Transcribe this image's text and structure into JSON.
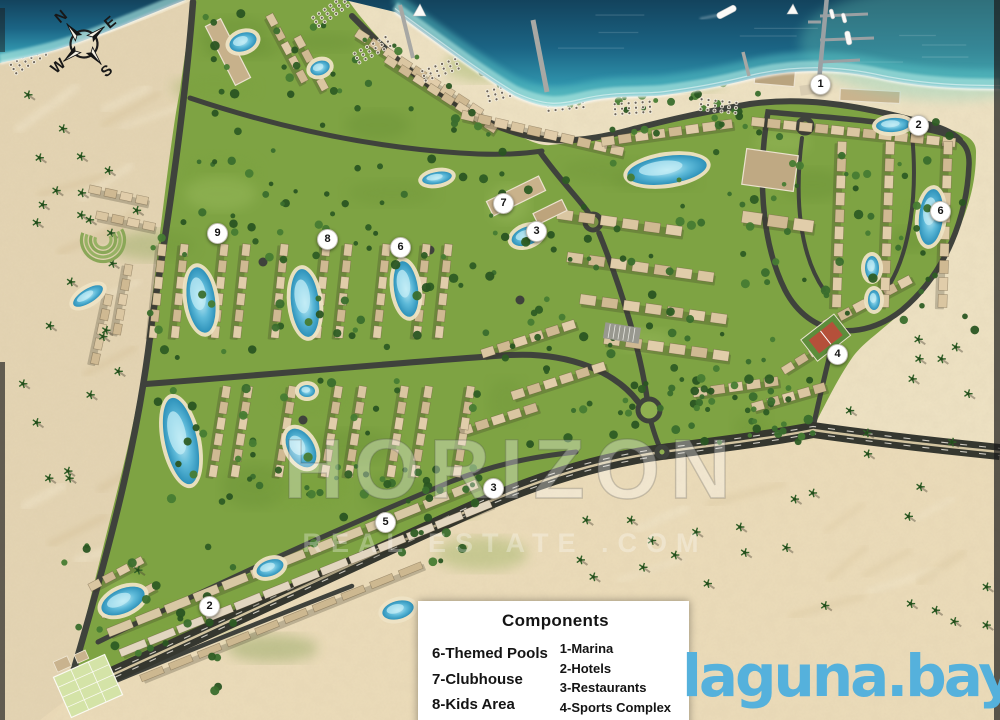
{
  "compass": {
    "n": "N",
    "e": "E",
    "s": "S",
    "w": "W"
  },
  "watermark": {
    "line1": "HORIZON",
    "line2": "REAL ESTATE .COM"
  },
  "legend": {
    "title": "Components",
    "left": [
      "6-Themed Pools",
      "7-Clubhouse",
      "8-Kids Area",
      "9-Amphitheater"
    ],
    "right": [
      "1-Marina",
      "2-Hotels",
      "3-Restaurants",
      "4-Sports Complex",
      "5-Commercial Strip"
    ]
  },
  "logo": {
    "text": "laguna.bay",
    "color": "#55b1dc"
  },
  "markers": [
    {
      "label": "1",
      "x": 820,
      "y": 84
    },
    {
      "label": "2",
      "x": 918,
      "y": 125
    },
    {
      "label": "6",
      "x": 940,
      "y": 211
    },
    {
      "label": "7",
      "x": 503,
      "y": 203
    },
    {
      "label": "3",
      "x": 536,
      "y": 231
    },
    {
      "label": "9",
      "x": 217,
      "y": 233
    },
    {
      "label": "8",
      "x": 327,
      "y": 239
    },
    {
      "label": "6",
      "x": 400,
      "y": 247
    },
    {
      "label": "4",
      "x": 837,
      "y": 354
    },
    {
      "label": "3",
      "x": 493,
      "y": 488
    },
    {
      "label": "5",
      "x": 385,
      "y": 522
    },
    {
      "label": "2",
      "x": 209,
      "y": 606
    }
  ],
  "colors": {
    "sea_deep": "#1b6484",
    "sea_shallow": "#a9e4de",
    "sand_beach": "#f0e4c5",
    "sand_desert": "#e3d3b0",
    "greenery": "#7ea343",
    "road": "#3f423c",
    "pool": "#5ebad9",
    "marker_bg": "#ffffff"
  }
}
